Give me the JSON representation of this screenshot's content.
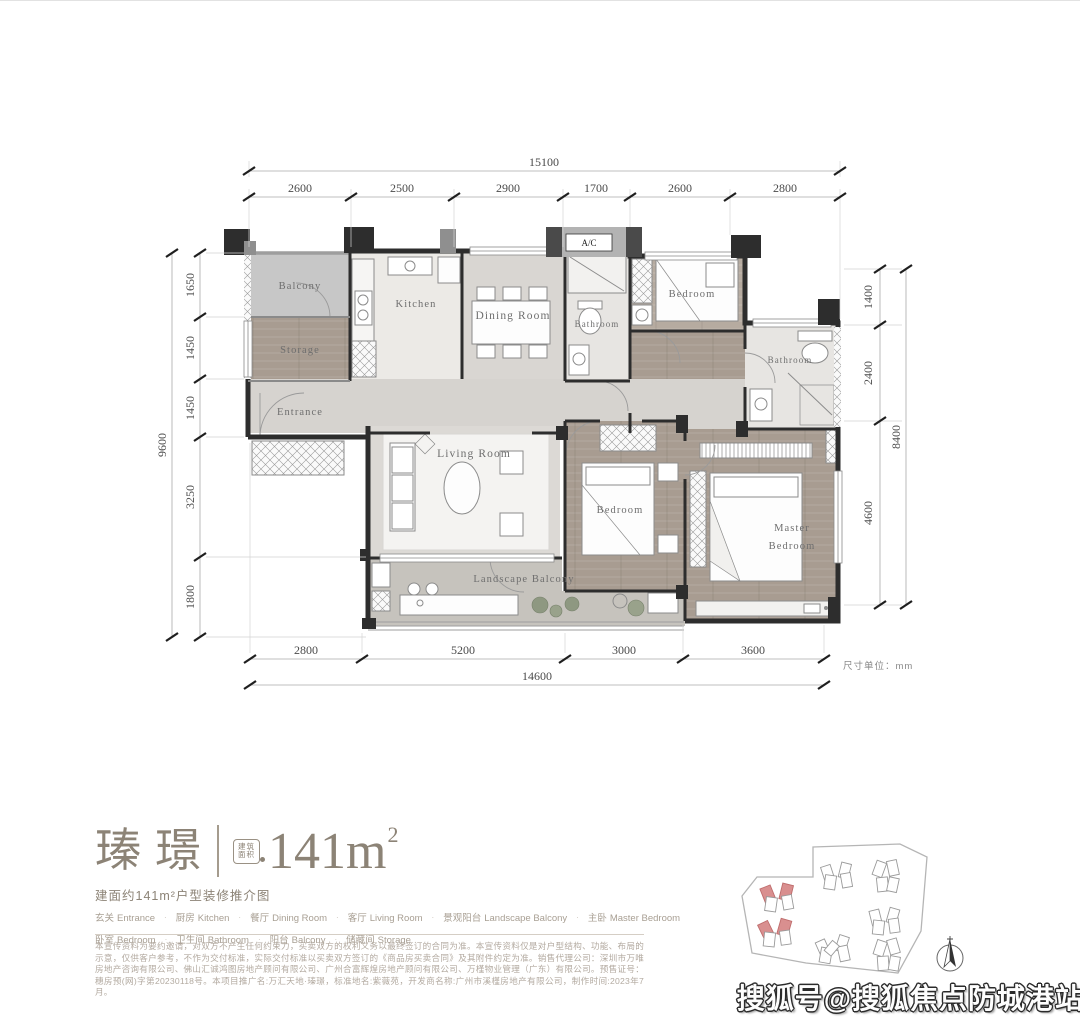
{
  "colors": {
    "accent": "#8c8376",
    "wall": "#2d2d2d",
    "red_building": "#d98f8f"
  },
  "plan": {
    "ac": "A/C",
    "unit_note": "尺寸单位：mm",
    "rooms": {
      "balcony": "Balcony",
      "storage": "Storage",
      "kitchen": "Kitchen",
      "dining": "Dining Room",
      "entrance": "Entrance",
      "bath1": "Bathroom",
      "bedroom_top": "Bedroom",
      "bath2": "Bathroom",
      "living": "Living Room",
      "bedroom_mid": "Bedroom",
      "master1": "Master",
      "master2": "Bedroom",
      "landscape": "Landscape Balcony"
    },
    "dims": {
      "top": {
        "total": "15100",
        "segs": [
          "2600",
          "2500",
          "2900",
          "1700",
          "2600",
          "2800"
        ]
      },
      "left": {
        "total": "9600",
        "segs": [
          "1650",
          "1450",
          "1450",
          "3250",
          "1800"
        ]
      },
      "right": {
        "total": "8400",
        "segs": [
          "1400",
          "2400",
          "4600"
        ]
      },
      "bottom": {
        "total": "14600",
        "segs": [
          "2800",
          "5200",
          "3000",
          "3600"
        ]
      }
    }
  },
  "title": {
    "cn": "瑧璟",
    "badge1": "建筑",
    "badge2": "面积",
    "area": "141m",
    "area_sup": "2",
    "subtitle": "建面约141m²户型装修推介图"
  },
  "legend": {
    "sep": "·",
    "row1": [
      {
        "zh": "玄关",
        "en": "Entrance"
      },
      {
        "zh": "厨房",
        "en": "Kitchen"
      },
      {
        "zh": "餐厅",
        "en": "Dining Room"
      },
      {
        "zh": "客厅",
        "en": "Living Room"
      },
      {
        "zh": "景观阳台",
        "en": "Landscape Balcony"
      },
      {
        "zh": "主卧",
        "en": "Master Bedroom"
      }
    ],
    "row2": [
      {
        "zh": "卧室",
        "en": "Bedroom"
      },
      {
        "zh": "卫生间",
        "en": "Bathroom"
      },
      {
        "zh": "阳台",
        "en": "Balcony"
      },
      {
        "zh": "储藏间",
        "en": "Storage"
      }
    ]
  },
  "disclaimer": {
    "text": "本宣传资料为要约邀请，对双方不产生任何约束力，买卖双方的权利义务以最终签订的合同为准。本宣传资料仅是对户型结构、功能、布局的示意，仅供客户参考，不作为交付标准，实际交付标准以买卖双方签订的《商品房买卖合同》及其附件约定为准。销售代理公司：深圳市万唯房地产咨询有限公司、佛山汇诚鸿图房地产顾问有限公司、广州合富辉煌房地产顾问有限公司、万槿物业管理（广东）有限公司。预售证号：穗房预(网)字第20230118号。本项目推广名:万汇天地·瑧璟，标准地名:紫薇苑，开发商名称:广州市溪槿房地产有限公司，制作时间:2023年7月。"
  },
  "watermark": {
    "text": "搜狐号@搜狐焦点防城港站"
  }
}
